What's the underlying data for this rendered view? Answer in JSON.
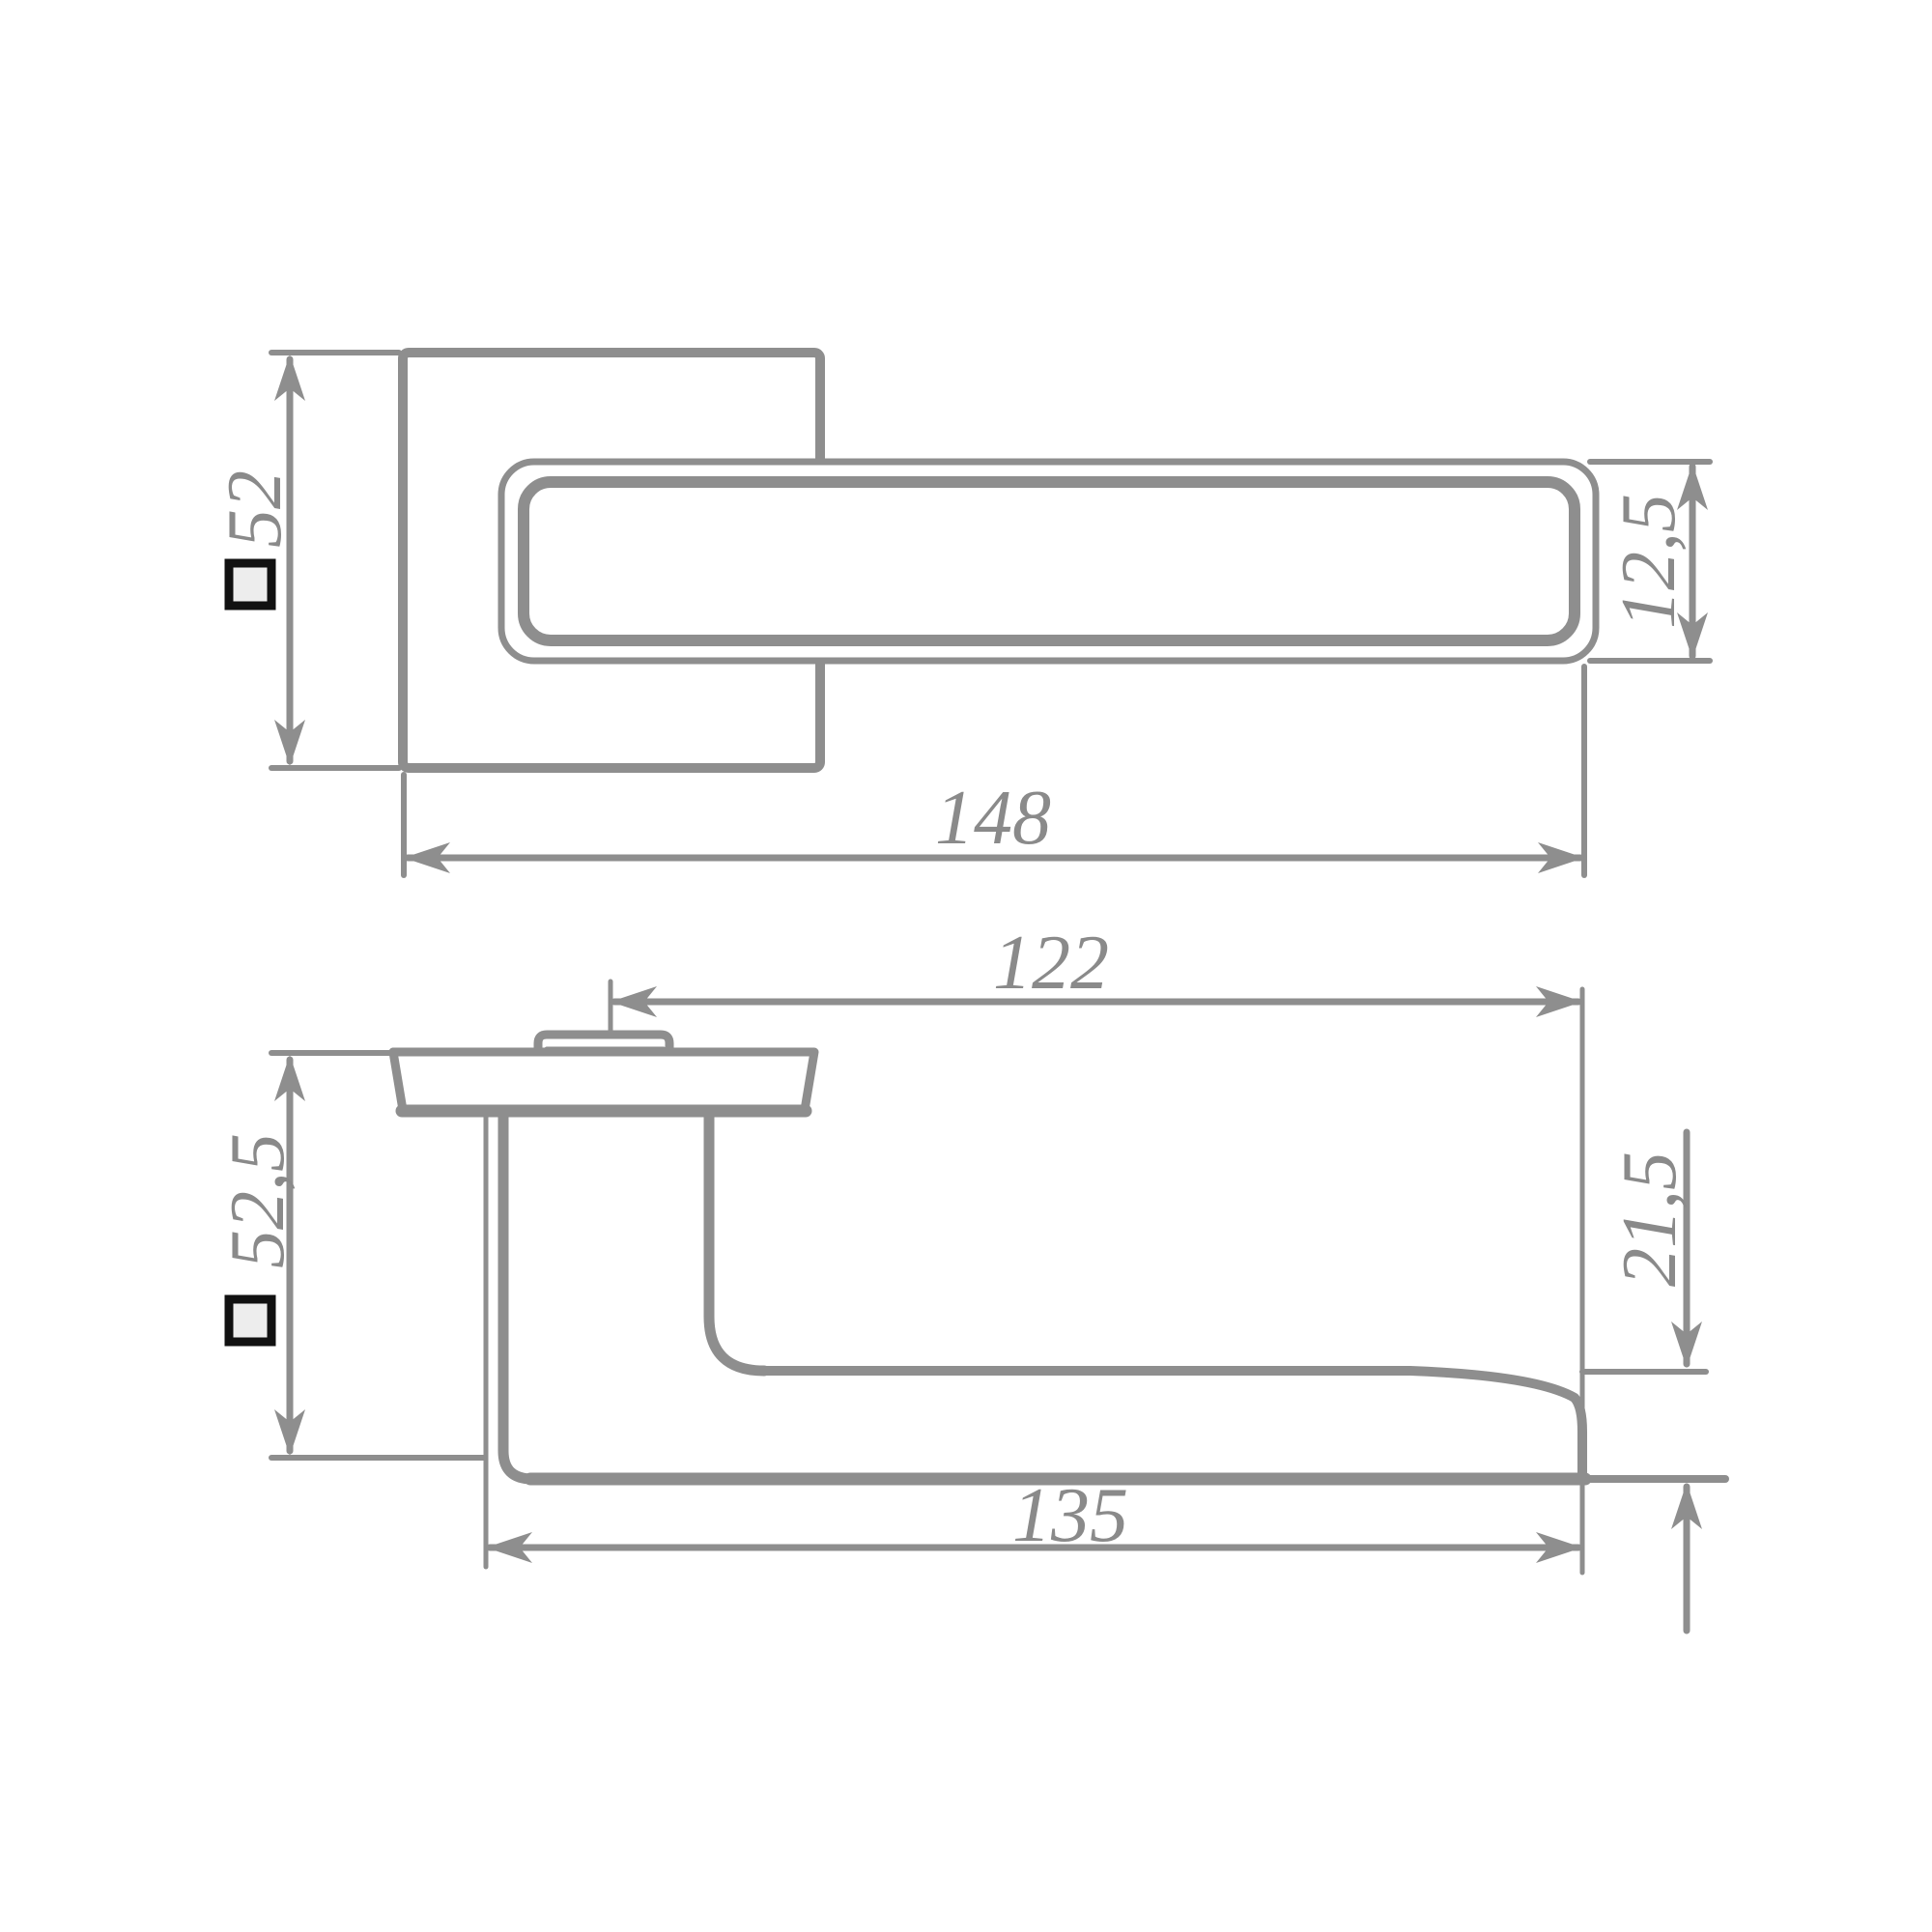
{
  "drawing": {
    "type": "technical-dimension-drawing",
    "subject": "door lever handle on square rosette, two orthographic views",
    "background": "#ffffff",
    "line_color": "#8e8e8e",
    "label_color": "#8a8a8a",
    "square_symbol": {
      "stroke": "#111111",
      "fill": "#ededed",
      "meaning": "square-section symbol"
    },
    "views": {
      "face": {
        "label": "face view (rosette with lever)",
        "dimensions": {
          "rosette_size": {
            "value": "52",
            "square_prefix": true
          },
          "lever_width": {
            "value": "12,5"
          },
          "overall_length": {
            "value": "148"
          }
        }
      },
      "profile": {
        "label": "profile view (projection)",
        "dimensions": {
          "spindle_to_end": {
            "value": "122"
          },
          "projection": {
            "value": "52,5",
            "square_prefix": true
          },
          "grip_end_thickness": {
            "value": "21,5"
          },
          "grip_length": {
            "value": "135"
          }
        }
      }
    }
  }
}
